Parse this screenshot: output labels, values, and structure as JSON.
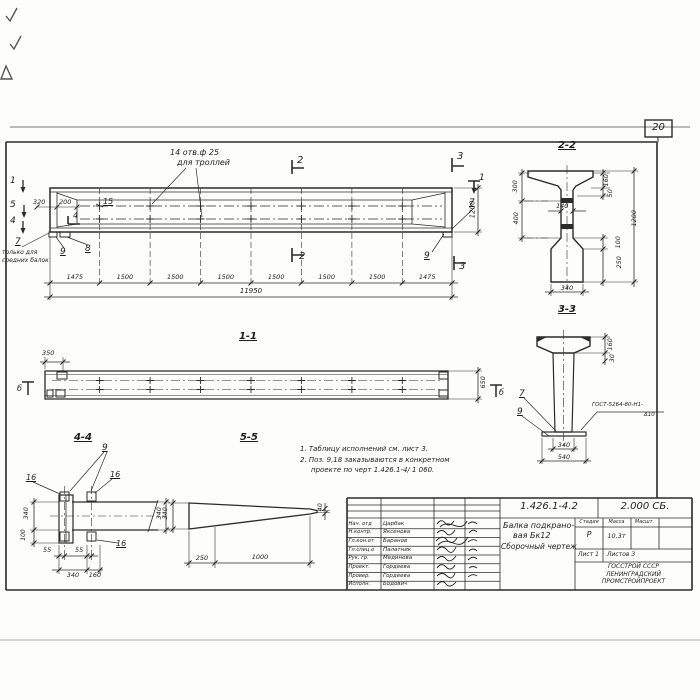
{
  "page": {
    "sheet_number": "20"
  },
  "elevation": {
    "marks": {
      "left_top": "1",
      "left_mid": "5",
      "left_bot": "4",
      "inner": "4",
      "cut2_top": "2",
      "cut2_bot": "2",
      "cut3_top": "3",
      "cut3_bot": "3",
      "right_top": "1"
    },
    "labels": {
      "holes_line1": "14 отв.ф 25",
      "holes_line2": "для троллей",
      "pos15": "15",
      "pos7": "7",
      "pos7_note1": "только для",
      "pos7_note2": "средних балок",
      "pos9": "9",
      "pos8": "8",
      "pos7_right": "7",
      "pos9_right": "9"
    },
    "dims": {
      "d320": "320",
      "d200": "200",
      "height": "1200",
      "segments": [
        "1475",
        "1500",
        "1500",
        "1500",
        "1500",
        "1500",
        "1500",
        "1475"
      ],
      "total": "11950"
    }
  },
  "section_2_2": {
    "title": "2-2",
    "left_top": "300",
    "left_bot": "400",
    "right_flange": "160",
    "right_taper": "50",
    "web": "140",
    "overall": "1200",
    "bulb_taper": "100",
    "bulb": "250",
    "bottom_width": "340"
  },
  "section_3_3": {
    "title": "3-3",
    "flange": "160",
    "taper": "30",
    "pos7": "7",
    "pos9": "9",
    "weld_line1": "ГОСТ-5264-80-Н1-",
    "weld_line2": "Δ10",
    "web_width": "340",
    "plate_width": "540"
  },
  "section_1_1": {
    "title": "1-1",
    "end_offset": "350",
    "width": "650",
    "mark_left": "б",
    "mark_right": "б"
  },
  "section_4_4": {
    "title": "4-4",
    "pos9": "9",
    "pos16_a": "16",
    "pos16_b": "16",
    "pos16_c": "16",
    "height": "340",
    "plate_drop": "100",
    "bolt_offset_a": "55",
    "bolt_offset_b": "55",
    "bottom_340": "340",
    "bottom_160": "160",
    "stub_height": "340"
  },
  "section_5_5": {
    "title": "5-5",
    "left_height": "340",
    "right_height": "40",
    "bottom_250": "250",
    "bottom_1000": "1000"
  },
  "notes": {
    "line1": "1. Таблицу исполнений см. лист 3.",
    "line2": "2. Поз. 9,18 заказываются в конкретном",
    "line3": "проекте по черт 1.426.1-4/ 1 060."
  },
  "titleblock": {
    "doc_number": "1.426.1-4.2",
    "doc_code": "2.000 СБ.",
    "title1": "Балка подкрано-",
    "title2": "вая Бк12",
    "title3": "Сборочный чертеж",
    "stage_h": "Стадия",
    "mass_h": "Масса",
    "scale_h": "Масшт.",
    "stage": "Р",
    "mass": "10,3т",
    "sheet": "Лист 1",
    "sheets": "Листов 3",
    "org1": "ГОССТРОЙ СССР",
    "org2": "ЛЕНИНГРАДСКИЙ",
    "org3": "ПРОМСТРОЙПРОЕКТ",
    "rows": [
      {
        "role": "Нач. отд",
        "name": "Царбак"
      },
      {
        "role": "Н.контр.",
        "name": "Яксенова"
      },
      {
        "role": "Гл.кон.от",
        "name": "Баранов"
      },
      {
        "role": "Гл.спец.о",
        "name": "Палатник"
      },
      {
        "role": "Рук. гр.",
        "name": "Мединова"
      },
      {
        "role": "Проект.",
        "name": "Гордеева"
      },
      {
        "role": "Провер.",
        "name": "Гордеева"
      },
      {
        "role": "Исполн.",
        "name": "Бодович"
      }
    ]
  }
}
